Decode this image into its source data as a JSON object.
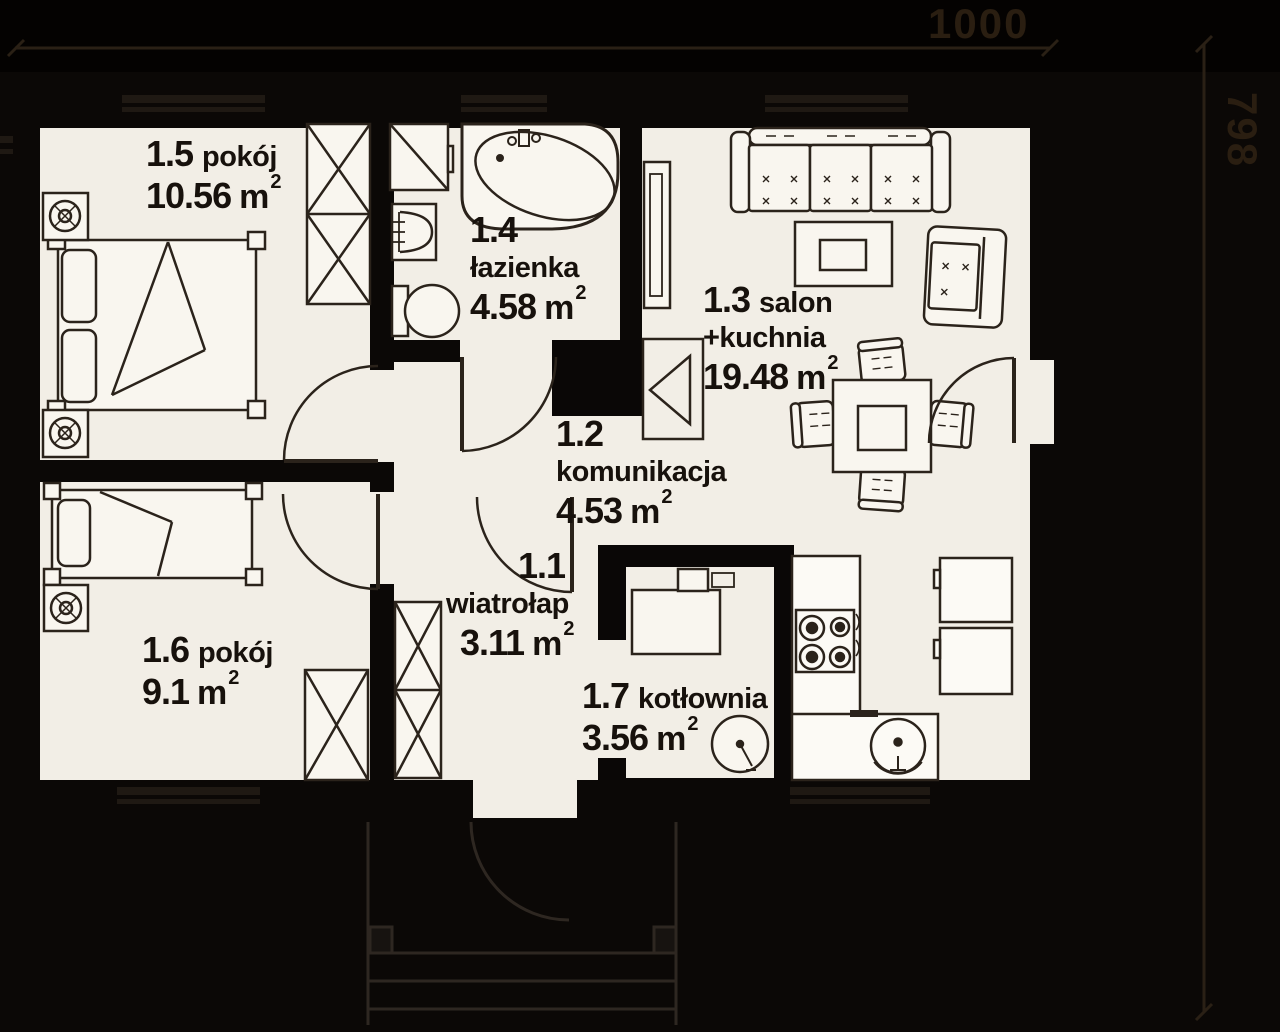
{
  "plan": {
    "title": "floor plan",
    "dimensions": {
      "width_label": "1000",
      "height_label": "798"
    },
    "unit": {
      "base": "m",
      "sup": "2"
    },
    "rooms": [
      {
        "number": "1.5",
        "name": "pokój",
        "area": "10.56"
      },
      {
        "number": "1.4",
        "name": "łazienka",
        "area": "4.58"
      },
      {
        "number": "1.3",
        "name": "salon",
        "name2": "+kuchnia",
        "area": "19.48"
      },
      {
        "number": "1.2",
        "name": "komunikacja",
        "area": "4.53"
      },
      {
        "number": "1.1",
        "name": "wiatrołap",
        "area": "3.11"
      },
      {
        "number": "1.6",
        "name": "pokój",
        "area": "9.1"
      },
      {
        "number": "1.7",
        "name": "kotłownia",
        "area": "3.56"
      }
    ],
    "colors": {
      "background": "#0b0806",
      "wall": "#0a0706",
      "floor": "#f2eee6",
      "furniture_fill": "#f9f6ef",
      "line": "#2b231b",
      "dimension": "#2a1e11"
    },
    "furniture_icons": [
      "double-bed",
      "single-bed",
      "nightstand-lamp",
      "wardrobe",
      "shower",
      "corner-bathtub",
      "washbasin",
      "toilet",
      "sofa",
      "coffee-table",
      "armchair",
      "tv-cabinet",
      "fireplace",
      "dining-table",
      "chair",
      "kitchen-counter",
      "stove",
      "sink",
      "fridge",
      "boiler",
      "water-tank",
      "entry-door",
      "window",
      "entry-steps"
    ]
  }
}
